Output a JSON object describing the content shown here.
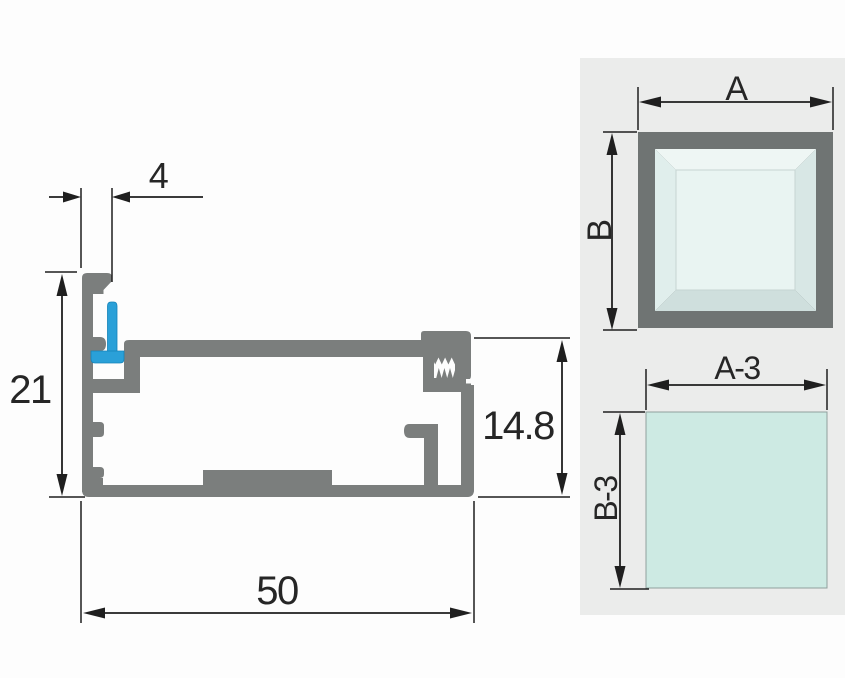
{
  "colors": {
    "canvas_bg": "#fdfdfd",
    "profile_gray": "#7b7e7d",
    "gasket_blue": "#2aa0d8",
    "gasket_blue_dark": "#1583b8",
    "dim_line": "#1f1f1f",
    "panel_bg": "#ebeceb",
    "frame_gray": "#6f7473",
    "bevel_light": "#eef6f4",
    "bevel_mid": "#e0eeec",
    "bevel_dark2": "#d8e7e5",
    "bevel_dark": "#cfdfdd",
    "glass_center": "#e9f4f2",
    "glass_teal": "#cdeae3"
  },
  "profile_drawing": {
    "dims": {
      "groove_width": "4",
      "fin_height": "21",
      "pocket_height": "14.8",
      "overall_width": "50"
    }
  },
  "size_panel": {
    "frame_diagram": {
      "width_label": "A",
      "height_label": "B"
    },
    "glass_diagram": {
      "width_label": "A-3",
      "height_label": "B-3"
    }
  }
}
